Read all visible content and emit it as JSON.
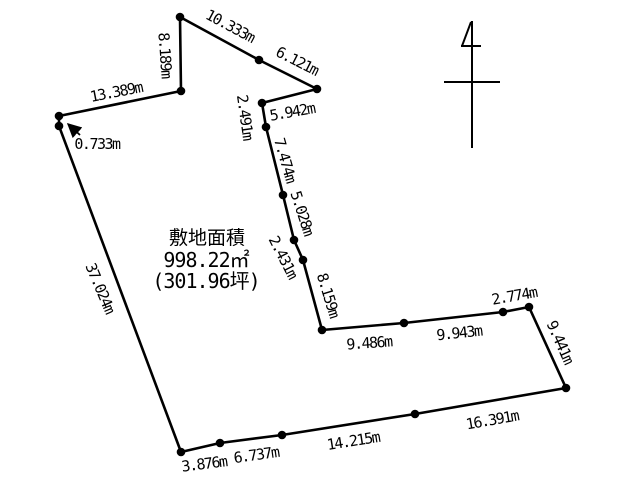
{
  "diagram": {
    "type": "land-survey-plot",
    "site_area": {
      "label": "敷地面積",
      "area_sqm_text": "998.22㎡",
      "area_tsubo_text": "(301.96坪)",
      "area_sqm_value": 998.22,
      "area_tsubo_value": 301.96
    },
    "segments": [
      {
        "label": "10.333m",
        "length_m": 10.333
      },
      {
        "label": "6.121m",
        "length_m": 6.121
      },
      {
        "label": "5.942m",
        "length_m": 5.942
      },
      {
        "label": "2.491m",
        "length_m": 2.491
      },
      {
        "label": "7.474m",
        "length_m": 7.474
      },
      {
        "label": "5.028m",
        "length_m": 5.028
      },
      {
        "label": "2.431m",
        "length_m": 2.431
      },
      {
        "label": "8.159m",
        "length_m": 8.159
      },
      {
        "label": "9.486m",
        "length_m": 9.486
      },
      {
        "label": "9.943m",
        "length_m": 9.943
      },
      {
        "label": "2.774m",
        "length_m": 2.774
      },
      {
        "label": "9.441m",
        "length_m": 9.441
      },
      {
        "label": "16.391m",
        "length_m": 16.391
      },
      {
        "label": "14.215m",
        "length_m": 14.215
      },
      {
        "label": "6.737m",
        "length_m": 6.737
      },
      {
        "label": "3.876m",
        "length_m": 3.876
      },
      {
        "label": "37.024m",
        "length_m": 37.024
      },
      {
        "label": "0.733m",
        "length_m": 0.733
      },
      {
        "label": "13.389m",
        "length_m": 13.389
      },
      {
        "label": "8.189m",
        "length_m": 8.189
      }
    ],
    "icons": {
      "north_mark": "north-arrow-icon",
      "leader": "leader-arrow-icon"
    },
    "colors": {
      "line": "#000000",
      "background": "#ffffff"
    }
  }
}
